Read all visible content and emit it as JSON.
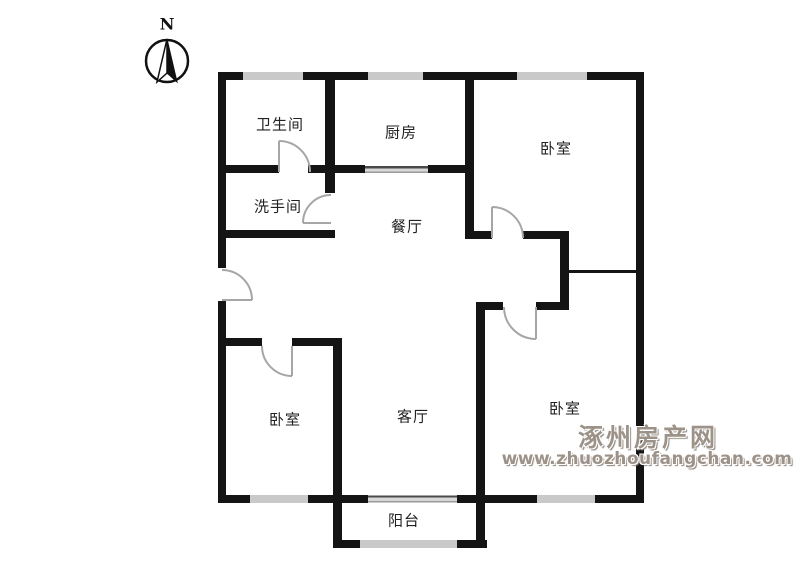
{
  "compass": {
    "north_label": "N"
  },
  "rooms": {
    "bathroom": {
      "label": "卫生间"
    },
    "washroom": {
      "label": "洗手间"
    },
    "kitchen": {
      "label": "厨房"
    },
    "dining": {
      "label": "餐厅"
    },
    "bedroom_top_right": {
      "label": "卧室"
    },
    "bedroom_bottom_left": {
      "label": "卧室"
    },
    "bedroom_bottom_right": {
      "label": "卧室"
    },
    "living": {
      "label": "客厅"
    },
    "balcony": {
      "label": "阳台"
    }
  },
  "watermark": {
    "site_name": "涿州房产网",
    "site_url": "www.zhuozhoufangchan.com",
    "color": "#9c9288"
  },
  "colors": {
    "wall": "#141414",
    "window_marker": "#c9c9c9",
    "door_arc": "#a6a6a6",
    "label_text": "#222222"
  }
}
